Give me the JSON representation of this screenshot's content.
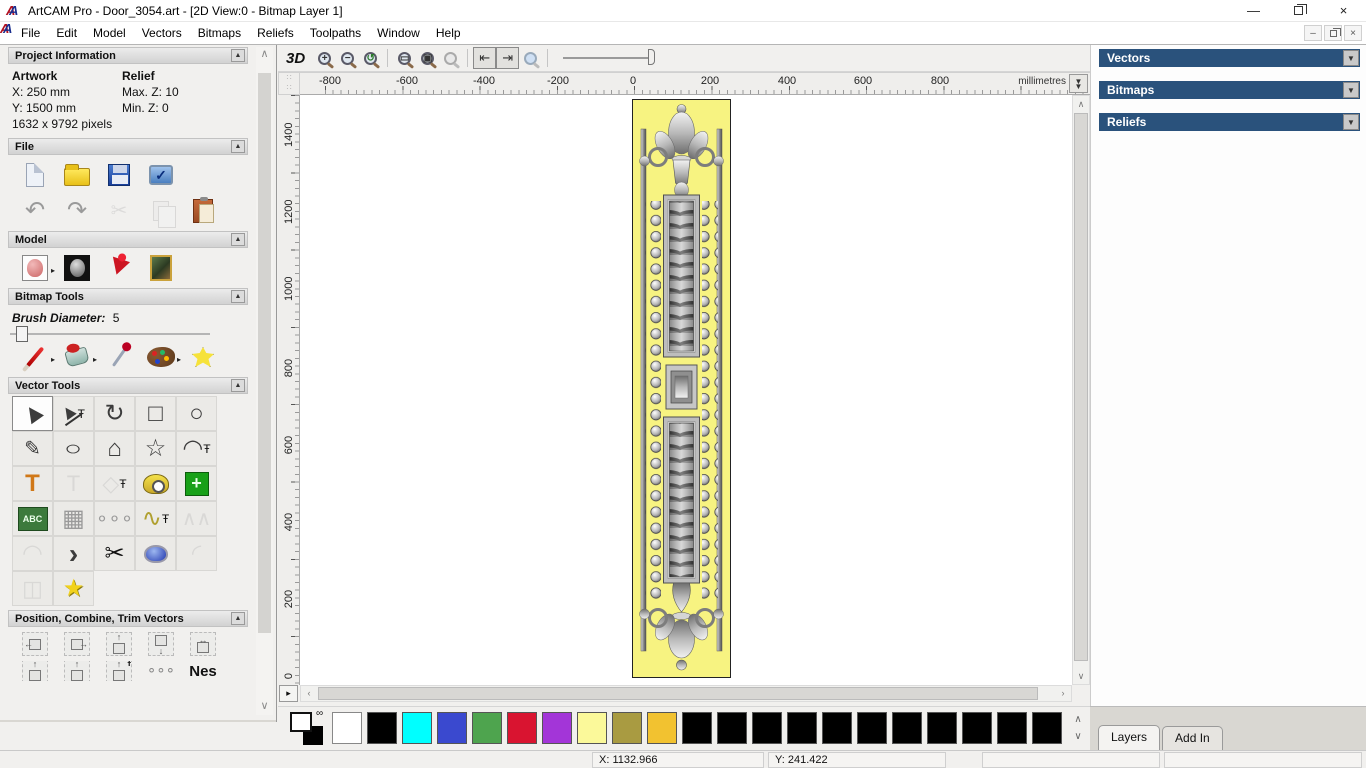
{
  "window": {
    "title": "ArtCAM Pro - Door_3054.art - [2D View:0 - Bitmap Layer 1]",
    "minimize": "—",
    "close": "×"
  },
  "menu": {
    "items": [
      "File",
      "Edit",
      "Model",
      "Vectors",
      "Bitmaps",
      "Reliefs",
      "Toolpaths",
      "Window",
      "Help"
    ]
  },
  "mdi": {
    "minimize": "–",
    "close": "×"
  },
  "assistant": {
    "project_information": {
      "title": "Project Information",
      "artwork_label": "Artwork",
      "relief_label": "Relief",
      "x": "X: 250 mm",
      "y": "Y: 1500 mm",
      "pixels": "1632 x 9792 pixels",
      "max_z": "Max. Z: 10",
      "min_z": "Min. Z: 0"
    },
    "file_section": {
      "title": "File"
    },
    "model_section": {
      "title": "Model"
    },
    "bitmap_tools": {
      "title": "Bitmap Tools",
      "brush_diameter_label": "Brush Diameter:",
      "brush_diameter_value": "5"
    },
    "vector_tools": {
      "title": "Vector Tools"
    },
    "position_section": {
      "title": "Position, Combine, Trim Vectors",
      "nesting_label": "Nes"
    },
    "tabs": {
      "assistant": "Assistant",
      "toolpaths": "Toolpaths"
    }
  },
  "canvas": {
    "toolbar": {
      "view_3d_label": "3D"
    },
    "ruler_units": "millimetres",
    "h_ticks": [
      "-800",
      "-600",
      "-400",
      "-200",
      "0",
      "200",
      "400",
      "600",
      "800"
    ],
    "v_ticks": [
      "1400",
      "1200",
      "1000",
      "800",
      "600",
      "400",
      "200",
      "0"
    ]
  },
  "right_panel": {
    "header_color": "#2a527c",
    "sections": [
      "Vectors",
      "Bitmaps",
      "Reliefs"
    ],
    "tabs": {
      "layers": "Layers",
      "add_in": "Add In"
    }
  },
  "palette": {
    "primary": "#ffffff",
    "secondary": "#000000",
    "colors": [
      "#ffffff",
      "#000000",
      "#00ffff",
      "#3a49cf",
      "#4ea44e",
      "#d91430",
      "#a335d8",
      "#fbf99a",
      "#a99b41",
      "#f2c230",
      "#000000",
      "#000000",
      "#000000",
      "#000000",
      "#000000",
      "#000000",
      "#000000",
      "#000000",
      "#000000",
      "#000000",
      "#000000"
    ]
  },
  "status": {
    "x": "X: 1132.966",
    "y": "Y: 241.422"
  },
  "icons": {
    "undo": "↶",
    "redo": "↷",
    "cut": "✂",
    "check": "✓",
    "select": "▶",
    "transform": "↻",
    "rectangle": "□",
    "circle": "○",
    "freehand": "✎",
    "ellipse": "○",
    "polygon": "⌂",
    "star": "☆",
    "arc": "◠",
    "text": "T",
    "offset": "◇",
    "abc": "ABC",
    "distort": "▦",
    "scatter": "∘∘∘",
    "nudge": "∿",
    "unwrap": "∧∧",
    "arc_fit": "◠",
    "join": "›",
    "weld_star": "★",
    "fillet": "◜",
    "slice": "◫",
    "flyout": "▸",
    "pin": "Ŧ",
    "collapse": "▲",
    "dropdown": "▼",
    "plus": "+",
    "minus": "−",
    "zoom_last": "↺",
    "zoom_rect": "▭",
    "zoom_fit": "▣",
    "toggle_left": "⇤",
    "toggle_right": "⇥",
    "up": "▲",
    "down": "▼",
    "left": "◄",
    "right": "►",
    "chev_up": "∧",
    "chev_down": "∨",
    "pan": "▸",
    "arrow_l": "←",
    "arrow_r": "→",
    "arrow_u": "↑",
    "arrow_d": "↓",
    "arrow_lr": "↔",
    "link": "∞",
    "corner": "∷"
  }
}
